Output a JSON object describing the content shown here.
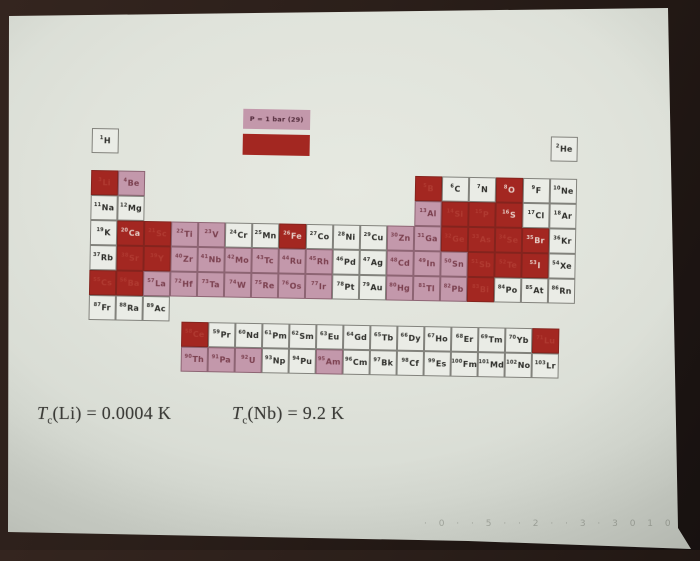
{
  "photo": {
    "faint_marks": "· 0 ·   · 5 ·  · 2 ·   · 3 ·    3    0 1 0"
  },
  "slide": {
    "legend": {
      "ambient_label": "P = 1 bar (29)",
      "ambient_color": "#c398ab",
      "pressure_color": "#a32721"
    },
    "footnotes": [
      {
        "var": "T",
        "sub": "c",
        "rest": "(Li) = 0.0004 K"
      },
      {
        "var": "T",
        "sub": "c",
        "rest": "(Nb) = 9.2 K"
      }
    ],
    "periodic_table": {
      "category_colors": {
        "n": "#eaece6",
        "a": "#c398ab",
        "p": "#a32721"
      },
      "elements": [
        {
          "z": 1,
          "s": "H",
          "r": 1,
          "col": 1,
          "c": "n"
        },
        {
          "z": 2,
          "s": "He",
          "r": 1,
          "col": 18,
          "c": "n"
        },
        {
          "z": 3,
          "s": "Li",
          "r": 2,
          "col": 1,
          "c": "p",
          "t": "f"
        },
        {
          "z": 4,
          "s": "Be",
          "r": 2,
          "col": 2,
          "c": "a"
        },
        {
          "z": 5,
          "s": "B",
          "r": 2,
          "col": 13,
          "c": "p",
          "t": "f"
        },
        {
          "z": 6,
          "s": "C",
          "r": 2,
          "col": 14,
          "c": "n"
        },
        {
          "z": 7,
          "s": "N",
          "r": 2,
          "col": 15,
          "c": "n"
        },
        {
          "z": 8,
          "s": "O",
          "r": 2,
          "col": 16,
          "c": "p",
          "t": "w"
        },
        {
          "z": 9,
          "s": "F",
          "r": 2,
          "col": 17,
          "c": "n"
        },
        {
          "z": 10,
          "s": "Ne",
          "r": 2,
          "col": 18,
          "c": "n"
        },
        {
          "z": 11,
          "s": "Na",
          "r": 3,
          "col": 1,
          "c": "n"
        },
        {
          "z": 12,
          "s": "Mg",
          "r": 3,
          "col": 2,
          "c": "n"
        },
        {
          "z": 13,
          "s": "Al",
          "r": 3,
          "col": 13,
          "c": "a"
        },
        {
          "z": 14,
          "s": "Si",
          "r": 3,
          "col": 14,
          "c": "p",
          "t": "f"
        },
        {
          "z": 15,
          "s": "P",
          "r": 3,
          "col": 15,
          "c": "p",
          "t": "f"
        },
        {
          "z": 16,
          "s": "S",
          "r": 3,
          "col": 16,
          "c": "p",
          "t": "w"
        },
        {
          "z": 17,
          "s": "Cl",
          "r": 3,
          "col": 17,
          "c": "n"
        },
        {
          "z": 18,
          "s": "Ar",
          "r": 3,
          "col": 18,
          "c": "n"
        },
        {
          "z": 19,
          "s": "K",
          "r": 4,
          "col": 1,
          "c": "n"
        },
        {
          "z": 20,
          "s": "Ca",
          "r": 4,
          "col": 2,
          "c": "p",
          "t": "w"
        },
        {
          "z": 21,
          "s": "Sc",
          "r": 4,
          "col": 3,
          "c": "p",
          "t": "f"
        },
        {
          "z": 22,
          "s": "Ti",
          "r": 4,
          "col": 4,
          "c": "a"
        },
        {
          "z": 23,
          "s": "V",
          "r": 4,
          "col": 5,
          "c": "a"
        },
        {
          "z": 24,
          "s": "Cr",
          "r": 4,
          "col": 6,
          "c": "n"
        },
        {
          "z": 25,
          "s": "Mn",
          "r": 4,
          "col": 7,
          "c": "n"
        },
        {
          "z": 26,
          "s": "Fe",
          "r": 4,
          "col": 8,
          "c": "p",
          "t": "w"
        },
        {
          "z": 27,
          "s": "Co",
          "r": 4,
          "col": 9,
          "c": "n"
        },
        {
          "z": 28,
          "s": "Ni",
          "r": 4,
          "col": 10,
          "c": "n"
        },
        {
          "z": 29,
          "s": "Cu",
          "r": 4,
          "col": 11,
          "c": "n"
        },
        {
          "z": 30,
          "s": "Zn",
          "r": 4,
          "col": 12,
          "c": "a"
        },
        {
          "z": 31,
          "s": "Ga",
          "r": 4,
          "col": 13,
          "c": "a"
        },
        {
          "z": 32,
          "s": "Ge",
          "r": 4,
          "col": 14,
          "c": "p",
          "t": "f"
        },
        {
          "z": 33,
          "s": "As",
          "r": 4,
          "col": 15,
          "c": "p",
          "t": "f"
        },
        {
          "z": 34,
          "s": "Se",
          "r": 4,
          "col": 16,
          "c": "p",
          "t": "f"
        },
        {
          "z": 35,
          "s": "Br",
          "r": 4,
          "col": 17,
          "c": "p",
          "t": "w"
        },
        {
          "z": 36,
          "s": "Kr",
          "r": 4,
          "col": 18,
          "c": "n"
        },
        {
          "z": 37,
          "s": "Rb",
          "r": 5,
          "col": 1,
          "c": "n"
        },
        {
          "z": 38,
          "s": "Sr",
          "r": 5,
          "col": 2,
          "c": "p",
          "t": "f"
        },
        {
          "z": 39,
          "s": "Y",
          "r": 5,
          "col": 3,
          "c": "p",
          "t": "f"
        },
        {
          "z": 40,
          "s": "Zr",
          "r": 5,
          "col": 4,
          "c": "a"
        },
        {
          "z": 41,
          "s": "Nb",
          "r": 5,
          "col": 5,
          "c": "a"
        },
        {
          "z": 42,
          "s": "Mo",
          "r": 5,
          "col": 6,
          "c": "a"
        },
        {
          "z": 43,
          "s": "Tc",
          "r": 5,
          "col": 7,
          "c": "a"
        },
        {
          "z": 44,
          "s": "Ru",
          "r": 5,
          "col": 8,
          "c": "a"
        },
        {
          "z": 45,
          "s": "Rh",
          "r": 5,
          "col": 9,
          "c": "a"
        },
        {
          "z": 46,
          "s": "Pd",
          "r": 5,
          "col": 10,
          "c": "n"
        },
        {
          "z": 47,
          "s": "Ag",
          "r": 5,
          "col": 11,
          "c": "n"
        },
        {
          "z": 48,
          "s": "Cd",
          "r": 5,
          "col": 12,
          "c": "a"
        },
        {
          "z": 49,
          "s": "In",
          "r": 5,
          "col": 13,
          "c": "a"
        },
        {
          "z": 50,
          "s": "Sn",
          "r": 5,
          "col": 14,
          "c": "a"
        },
        {
          "z": 51,
          "s": "Sb",
          "r": 5,
          "col": 15,
          "c": "p",
          "t": "f"
        },
        {
          "z": 52,
          "s": "Te",
          "r": 5,
          "col": 16,
          "c": "p",
          "t": "f"
        },
        {
          "z": 53,
          "s": "I",
          "r": 5,
          "col": 17,
          "c": "p",
          "t": "w"
        },
        {
          "z": 54,
          "s": "Xe",
          "r": 5,
          "col": 18,
          "c": "n"
        },
        {
          "z": 55,
          "s": "Cs",
          "r": 6,
          "col": 1,
          "c": "p",
          "t": "f"
        },
        {
          "z": 56,
          "s": "Ba",
          "r": 6,
          "col": 2,
          "c": "p",
          "t": "f"
        },
        {
          "z": 57,
          "s": "La",
          "r": 6,
          "col": 3,
          "c": "a"
        },
        {
          "z": 72,
          "s": "Hf",
          "r": 6,
          "col": 4,
          "c": "a"
        },
        {
          "z": 73,
          "s": "Ta",
          "r": 6,
          "col": 5,
          "c": "a"
        },
        {
          "z": 74,
          "s": "W",
          "r": 6,
          "col": 6,
          "c": "a"
        },
        {
          "z": 75,
          "s": "Re",
          "r": 6,
          "col": 7,
          "c": "a"
        },
        {
          "z": 76,
          "s": "Os",
          "r": 6,
          "col": 8,
          "c": "a"
        },
        {
          "z": 77,
          "s": "Ir",
          "r": 6,
          "col": 9,
          "c": "a"
        },
        {
          "z": 78,
          "s": "Pt",
          "r": 6,
          "col": 10,
          "c": "n"
        },
        {
          "z": 79,
          "s": "Au",
          "r": 6,
          "col": 11,
          "c": "n"
        },
        {
          "z": 80,
          "s": "Hg",
          "r": 6,
          "col": 12,
          "c": "a"
        },
        {
          "z": 81,
          "s": "Tl",
          "r": 6,
          "col": 13,
          "c": "a"
        },
        {
          "z": 82,
          "s": "Pb",
          "r": 6,
          "col": 14,
          "c": "a"
        },
        {
          "z": 83,
          "s": "Bi",
          "r": 6,
          "col": 15,
          "c": "p",
          "t": "f"
        },
        {
          "z": 84,
          "s": "Po",
          "r": 6,
          "col": 16,
          "c": "n"
        },
        {
          "z": 85,
          "s": "At",
          "r": 6,
          "col": 17,
          "c": "n"
        },
        {
          "z": 86,
          "s": "Rn",
          "r": 6,
          "col": 18,
          "c": "n"
        },
        {
          "z": 87,
          "s": "Fr",
          "r": 7,
          "col": 1,
          "c": "n"
        },
        {
          "z": 88,
          "s": "Ra",
          "r": 7,
          "col": 2,
          "c": "n"
        },
        {
          "z": 89,
          "s": "Ac",
          "r": 7,
          "col": 3,
          "c": "n"
        },
        {
          "z": 58,
          "s": "Ce",
          "r": "L",
          "col": 1,
          "c": "p",
          "t": "f"
        },
        {
          "z": 59,
          "s": "Pr",
          "r": "L",
          "col": 2,
          "c": "n"
        },
        {
          "z": 60,
          "s": "Nd",
          "r": "L",
          "col": 3,
          "c": "n"
        },
        {
          "z": 61,
          "s": "Pm",
          "r": "L",
          "col": 4,
          "c": "n"
        },
        {
          "z": 62,
          "s": "Sm",
          "r": "L",
          "col": 5,
          "c": "n"
        },
        {
          "z": 63,
          "s": "Eu",
          "r": "L",
          "col": 6,
          "c": "n"
        },
        {
          "z": 64,
          "s": "Gd",
          "r": "L",
          "col": 7,
          "c": "n"
        },
        {
          "z": 65,
          "s": "Tb",
          "r": "L",
          "col": 8,
          "c": "n"
        },
        {
          "z": 66,
          "s": "Dy",
          "r": "L",
          "col": 9,
          "c": "n"
        },
        {
          "z": 67,
          "s": "Ho",
          "r": "L",
          "col": 10,
          "c": "n"
        },
        {
          "z": 68,
          "s": "Er",
          "r": "L",
          "col": 11,
          "c": "n"
        },
        {
          "z": 69,
          "s": "Tm",
          "r": "L",
          "col": 12,
          "c": "n"
        },
        {
          "z": 70,
          "s": "Yb",
          "r": "L",
          "col": 13,
          "c": "n"
        },
        {
          "z": 71,
          "s": "Lu",
          "r": "L",
          "col": 14,
          "c": "p",
          "t": "f"
        },
        {
          "z": 90,
          "s": "Th",
          "r": "A",
          "col": 1,
          "c": "a"
        },
        {
          "z": 91,
          "s": "Pa",
          "r": "A",
          "col": 2,
          "c": "a"
        },
        {
          "z": 92,
          "s": "U",
          "r": "A",
          "col": 3,
          "c": "a"
        },
        {
          "z": 93,
          "s": "Np",
          "r": "A",
          "col": 4,
          "c": "n"
        },
        {
          "z": 94,
          "s": "Pu",
          "r": "A",
          "col": 5,
          "c": "n"
        },
        {
          "z": 95,
          "s": "Am",
          "r": "A",
          "col": 6,
          "c": "a"
        },
        {
          "z": 96,
          "s": "Cm",
          "r": "A",
          "col": 7,
          "c": "n"
        },
        {
          "z": 97,
          "s": "Bk",
          "r": "A",
          "col": 8,
          "c": "n"
        },
        {
          "z": 98,
          "s": "Cf",
          "r": "A",
          "col": 9,
          "c": "n"
        },
        {
          "z": 99,
          "s": "Es",
          "r": "A",
          "col": 10,
          "c": "n"
        },
        {
          "z": 100,
          "s": "Fm",
          "r": "A",
          "col": 11,
          "c": "n"
        },
        {
          "z": 101,
          "s": "Md",
          "r": "A",
          "col": 12,
          "c": "n"
        },
        {
          "z": 102,
          "s": "No",
          "r": "A",
          "col": 13,
          "c": "n"
        },
        {
          "z": 103,
          "s": "Lr",
          "r": "A",
          "col": 14,
          "c": "n"
        }
      ]
    }
  }
}
